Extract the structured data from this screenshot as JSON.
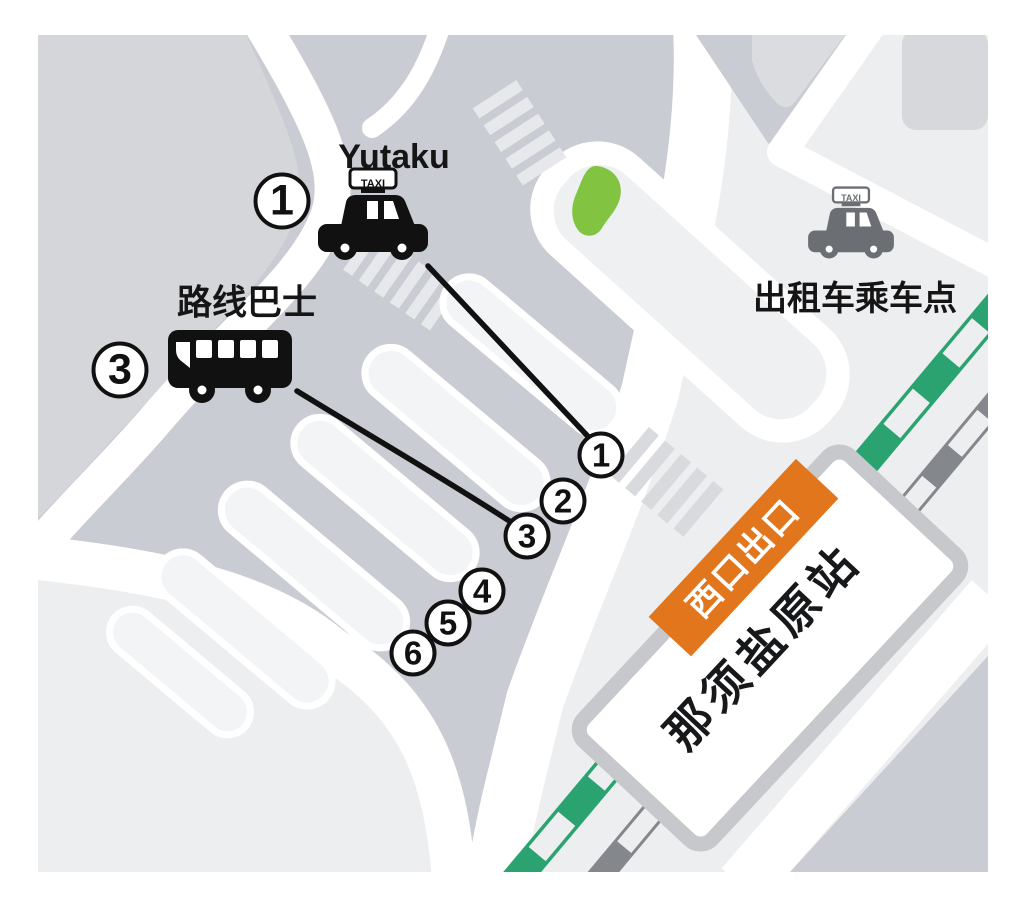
{
  "legend": {
    "taxi_company_label": "Yutaku",
    "taxi_company_marker": "1",
    "local_bus_label": "路线巴士",
    "local_bus_marker": "3",
    "taxi_pickup_label": "出租车乘车点"
  },
  "station": {
    "name": "那须盐原站",
    "west_exit_banner": "西口出口"
  },
  "taxi_sign_text": "TAXI",
  "bus_stops": [
    "1",
    "2",
    "3",
    "4",
    "5",
    "6"
  ],
  "colors": {
    "plaza_gray": "#c9ccd2",
    "block_gray": "#d4d6da",
    "light_area": "#edeef0",
    "road_white": "#ffffff",
    "banner_orange": "#e2761d",
    "greenery": "#82c341",
    "track_green": "#2ba371",
    "track_gray": "#84878b",
    "taxi_east_gray": "#6b6f74",
    "icon_black": "#111111",
    "station_border": "#c6c8cc"
  }
}
